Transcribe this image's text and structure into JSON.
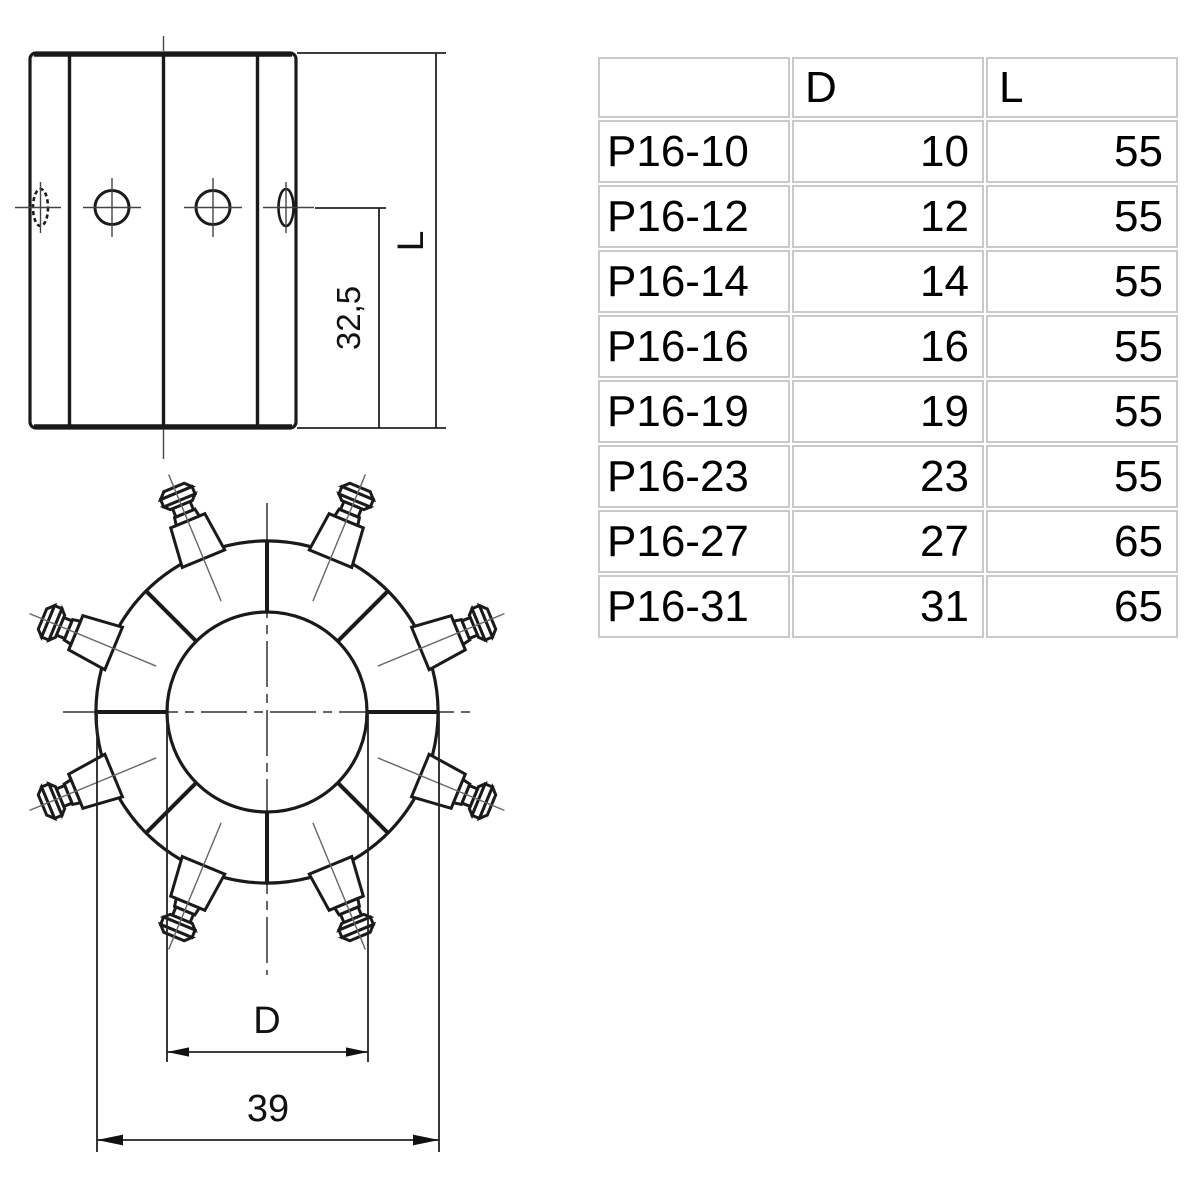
{
  "colors": {
    "line": "#1a1a1a",
    "thin_line": "#666666",
    "centerline": "#333333",
    "grid_border": "#c9c9c9"
  },
  "drawing": {
    "side_view": {
      "length_label": "L",
      "hole_offset_label": "32,5"
    },
    "front_view": {
      "bore_label": "D",
      "outer_diameter_label": "39"
    }
  },
  "table": {
    "columns": [
      "",
      "D",
      "L"
    ],
    "rows": [
      {
        "name": "P16-10",
        "d": 10,
        "l": 55
      },
      {
        "name": "P16-12",
        "d": 12,
        "l": 55
      },
      {
        "name": "P16-14",
        "d": 14,
        "l": 55
      },
      {
        "name": "P16-16",
        "d": 16,
        "l": 55
      },
      {
        "name": "P16-19",
        "d": 19,
        "l": 55
      },
      {
        "name": "P16-23",
        "d": 23,
        "l": 55
      },
      {
        "name": "P16-27",
        "d": 27,
        "l": 65
      },
      {
        "name": "P16-31",
        "d": 31,
        "l": 65
      }
    ]
  }
}
